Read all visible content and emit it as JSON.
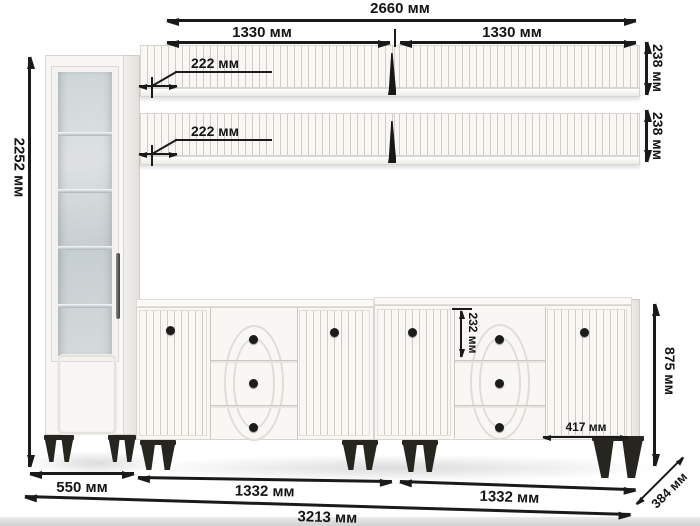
{
  "diagram": {
    "unit_system": "мм",
    "dimensions": {
      "shelves_total_width": "2660 мм",
      "shelf_section_left_width": "1330 мм",
      "shelf_section_right_width": "1330 мм",
      "shelf_depth_upper": "222 мм",
      "shelf_depth_lower": "222 мм",
      "shelf_height_upper": "238 мм",
      "shelf_height_lower": "238 мм",
      "cabinet_height": "2252 мм",
      "sideboard_height": "875 мм",
      "top_drawer_height": "232 мм",
      "door_width": "417 мм",
      "cabinet_width": "550 мм",
      "sideboard_left_width": "1332 мм",
      "sideboard_right_width": "1332 мм",
      "set_total_width": "3213 мм",
      "set_depth": "384 мм"
    },
    "colors": {
      "dimension_ink": "#1a1a1a",
      "furniture_white": "#f8f7f4",
      "furniture_shade": "#ecebe6",
      "glass": "#ccd3d5",
      "hardware_black": "#26251f",
      "background": "#ffffff"
    }
  }
}
